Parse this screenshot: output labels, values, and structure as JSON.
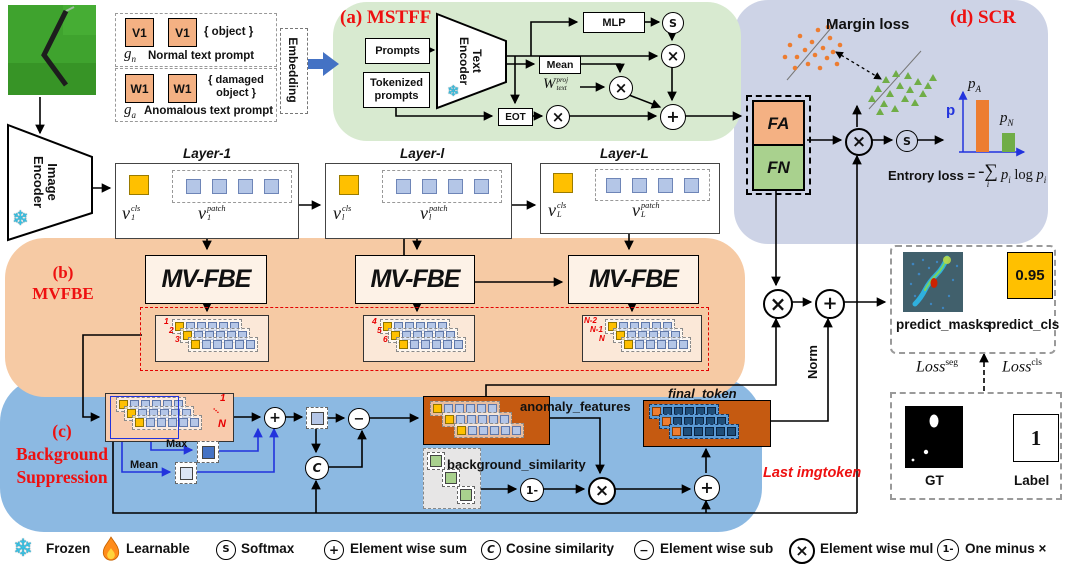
{
  "colors": {
    "region_a": "#d8ead0",
    "region_b": "#f6caa4",
    "region_c": "#8cb9e2",
    "region_d": "#cdd3e6",
    "accent_red": "#ee1010",
    "wire_blue": "#2233dd",
    "big_arrow_blue": "#4472c4",
    "cls_yellow": "#ffc000",
    "patch_blue": "#b4c6e7",
    "fa_orange": "#f4b183",
    "fn_green": "#a9d18e",
    "bar_orange": "#ed7d31",
    "bar_green": "#70ad47",
    "token_box_orange": "#c55a11"
  },
  "input_panel": {
    "normal_tokens": [
      "V1",
      "V1"
    ],
    "normal_object": "{ object }",
    "normal_g": "g",
    "normal_g_sub": "n",
    "normal_caption": "Normal text prompt",
    "anom_tokens": [
      "W1",
      "W1"
    ],
    "anom_object_l1": "{ damaged",
    "anom_object_l2": "object }",
    "anom_g": "g",
    "anom_g_sub": "a",
    "anom_caption": "Anomalous text prompt",
    "embedding": "Embedding"
  },
  "image_encoder": {
    "l1": "Image",
    "l2": "Encoder"
  },
  "mstff": {
    "title": "(a) MSTFF",
    "prompts": "Prompts",
    "tokenized_l1": "Tokenized",
    "tokenized_l2": "prompts",
    "enc_l1": "Text",
    "enc_l2": "Encoder",
    "mlp": "MLP",
    "mean": "Mean",
    "eot": "EOT",
    "w_var": "W",
    "w_sup": "proj",
    "w_sub": "text"
  },
  "layers": [
    {
      "title": "Layer-1",
      "v": "v",
      "sub": "1",
      "cls": "cls",
      "patch": "patch"
    },
    {
      "title": "Layer-l",
      "v": "v",
      "sub": "l",
      "cls": "cls",
      "patch": "patch"
    },
    {
      "title": "Layer-L",
      "v": "v",
      "sub": "L",
      "cls": "cls",
      "patch": "patch"
    }
  ],
  "mvfbe": {
    "title_l1": "(b)",
    "title_l2": "MVFBE",
    "box": "MV-FBE",
    "s1": [
      "1",
      "2",
      "3"
    ],
    "s2": [
      "4",
      "5",
      "6"
    ],
    "s3": [
      "N-2",
      "N-1",
      "N"
    ]
  },
  "scr": {
    "title": "(d) SCR",
    "margin": "Margin loss",
    "fa": "FA",
    "fn": "FN",
    "p": "p",
    "pa_base": "p",
    "pa_sub": "A",
    "pn_base": "p",
    "pn_sub": "N",
    "entropy_label": "Entrory loss =",
    "sigma": "-∑",
    "sigma_sub": "i",
    "f_p1": "p",
    "f_p1s": "i",
    "f_log": "log",
    "f_p2": "p",
    "f_p2s": "i"
  },
  "bgsup": {
    "title_l1": "(c)",
    "title_l2": "Background",
    "title_l3": "Suppression",
    "max": "Max",
    "mean": "Mean",
    "anomaly": "anomaly_features",
    "similarity": "background_similarity",
    "final": "final_token",
    "last": "Last imgtoken",
    "n1": "1",
    "dots": "...",
    "nN": "N",
    "norm": "Norm"
  },
  "ops": {
    "mul": "×",
    "sum": "+",
    "minus": "−",
    "softmax": "S",
    "cosine": "C",
    "one_minus": "1-"
  },
  "outputs": {
    "masks": "predict_masks",
    "cls": "predict_cls",
    "score": "0.95",
    "loss_seg_base": "Loss",
    "loss_seg_sup": "seg",
    "loss_cls_base": "Loss",
    "loss_cls_sup": "cls",
    "gt": "GT",
    "label": "Label",
    "label_value": "1"
  },
  "legend": {
    "frozen": "Frozen",
    "learnable": "Learnable",
    "softmax": "Softmax",
    "sum": "Element wise sum",
    "cosine": "Cosine similarity",
    "sub": "Element wise sub",
    "mul": "Element wise mul",
    "one_minus": "One minus ×"
  }
}
